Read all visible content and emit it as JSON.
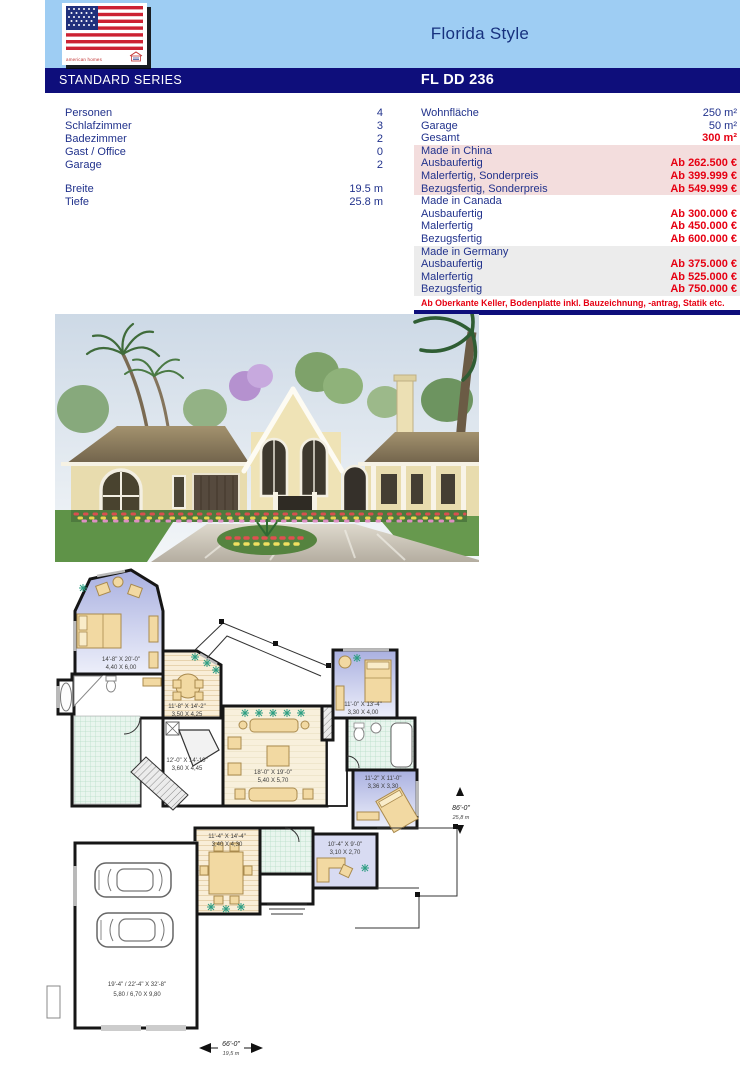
{
  "header": {
    "style_title": "Florida Style",
    "series_label": "STANDARD SERIES",
    "model_code": "FL DD 236",
    "logo_brand": "american homes"
  },
  "specs_left": {
    "rows": [
      {
        "label": "Personen",
        "value": "4"
      },
      {
        "label": "Schlafzimmer",
        "value": "3"
      },
      {
        "label": "Badezimmer",
        "value": "2"
      },
      {
        "label": "Gast / Office",
        "value": "0"
      },
      {
        "label": "Garage",
        "value": "2"
      }
    ],
    "dims": [
      {
        "label": "Breite",
        "value": "19.5 m"
      },
      {
        "label": "Tiefe",
        "value": "25.8 m"
      }
    ]
  },
  "specs_right": {
    "areas": [
      {
        "label": "Wohnfläche",
        "value": "250 m²"
      },
      {
        "label": "Garage",
        "value": "50 m²"
      },
      {
        "label": "Gesamt",
        "value": "300 m²"
      }
    ],
    "groups": [
      {
        "region": "Made in China",
        "rows": [
          {
            "label": "Ausbaufertig",
            "price": "Ab 262.500 €"
          },
          {
            "label": "Malerfertig, Sonderpreis",
            "price": "Ab 399.999 €"
          },
          {
            "label": "Bezugsfertig, Sonderpreis",
            "price": "Ab 549.999 €"
          }
        ]
      },
      {
        "region": "Made in Canada",
        "rows": [
          {
            "label": "Ausbaufertig",
            "price": "Ab 300.000 €"
          },
          {
            "label": "Malerfertig",
            "price": "Ab 450.000 €"
          },
          {
            "label": "Bezugsfertig",
            "price": "Ab 600.000 €"
          }
        ]
      },
      {
        "region": "Made in Germany",
        "rows": [
          {
            "label": "Ausbaufertig",
            "price": "Ab 375.000 €"
          },
          {
            "label": "Malerfertig",
            "price": "Ab 525.000 €"
          },
          {
            "label": "Bezugsfertig",
            "price": "Ab 750.000 €"
          }
        ]
      }
    ],
    "footnote": "Ab Oberkante Keller, Bodenplatte inkl. Bauzeichnung, -antrag, Statik etc."
  },
  "floor_plan": {
    "rooms": [
      {
        "ft": "14'-8\" X 20'-0\"",
        "m": "4,40 X 6,00"
      },
      {
        "ft": "11'-8\" X 14'-2\"",
        "m": "3,50 X 4,25"
      },
      {
        "ft": "11'-0\" X 13'-4\"",
        "m": "3,30 X 4,00"
      },
      {
        "ft": "12'-0\" X 14'-10\"",
        "m": "3,60 X 4,45"
      },
      {
        "ft": "18'-0\" X 19'-0\"",
        "m": "5,40 X 5,70"
      },
      {
        "ft": "11'-2\" X 11'-0\"",
        "m": "3,36 X 3,30"
      },
      {
        "ft": "11'-4\" X 14'-4\"",
        "m": "3,40 X 4,30"
      },
      {
        "ft": "10'-4\" X 9'-0\"",
        "m": "3,10 X 2,70"
      },
      {
        "ft": "19'-4\" / 22'-4\" X 32'-8\"",
        "m": "5,80 / 6,70 X 9,80"
      }
    ],
    "width": {
      "ft": "66'-0\"",
      "m": "19,5 m"
    },
    "depth": {
      "ft": "86'-0\"",
      "m": "25,8 m"
    }
  },
  "colors": {
    "header_blue": "#9ecdf3",
    "navy": "#0e0e7b",
    "text_navy": "#21328c",
    "price_red": "#e60012",
    "china_bg": "#f3dddd",
    "germany_bg": "#ececec",
    "plan_bedroom": "#b0b6e2",
    "plan_bath": "#e9f5ee",
    "plan_wood": "#f9eed8"
  }
}
